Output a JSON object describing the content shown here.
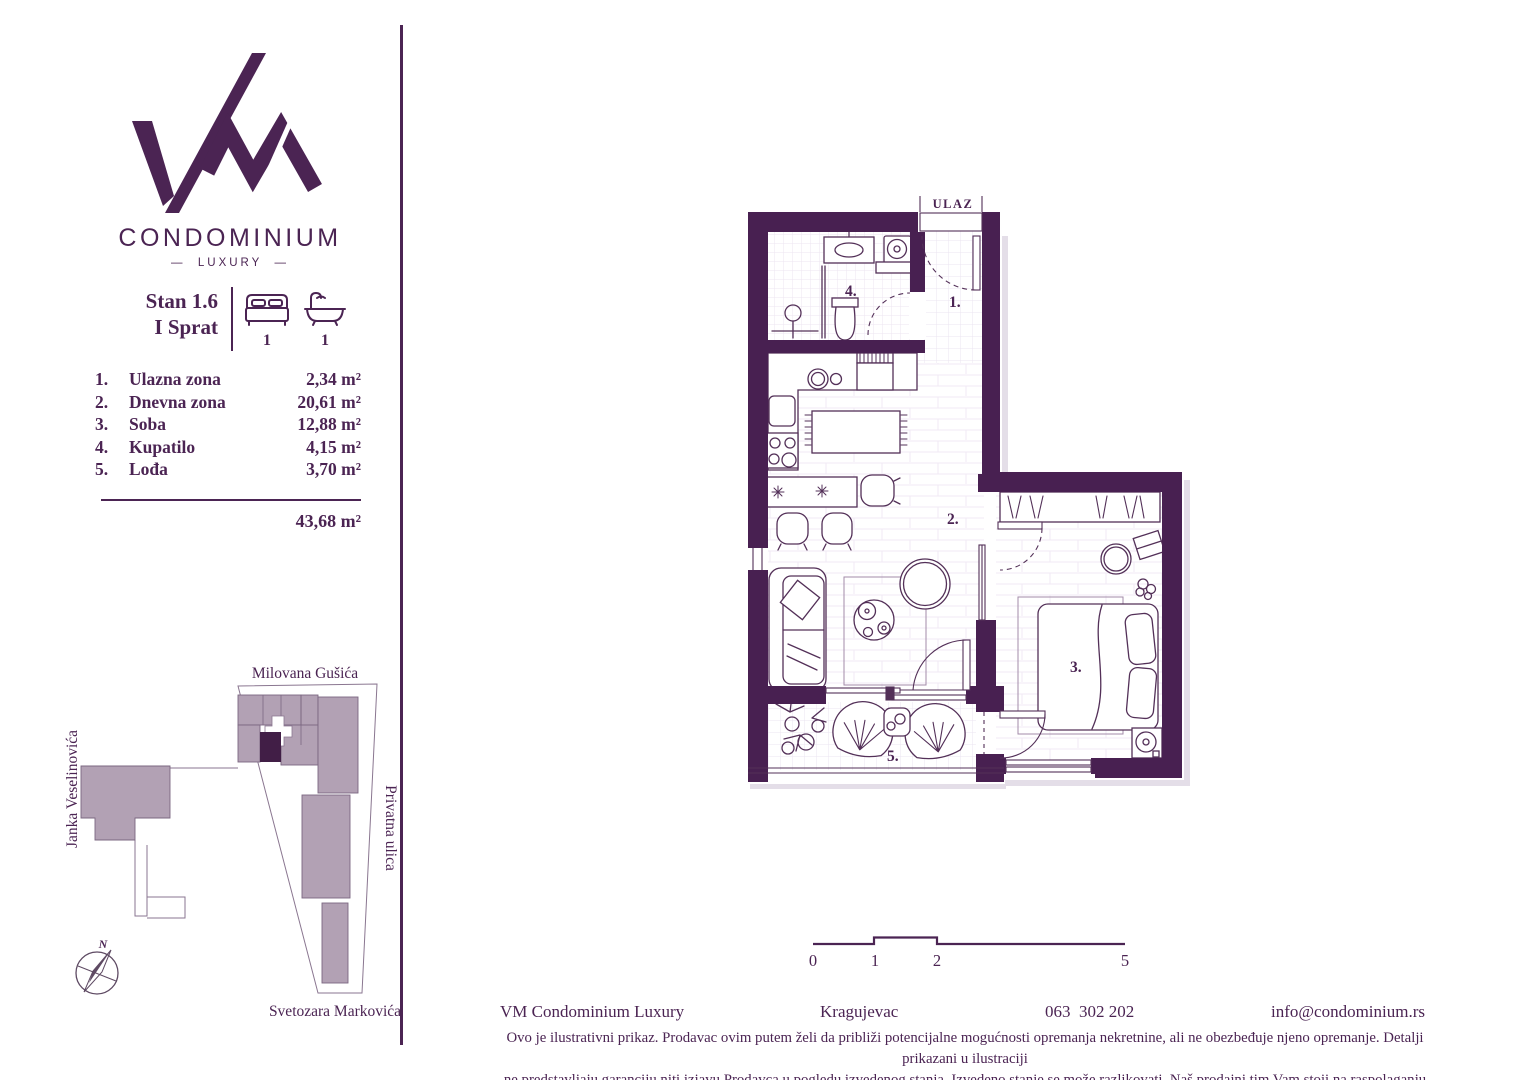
{
  "brand": {
    "monogram": "VM",
    "name": "CONDOMINIUM",
    "tagline_display": "—  LUXURY  —"
  },
  "unit": {
    "title_line1": "Stan 1.6",
    "title_line2": "I Sprat",
    "bedrooms": "1",
    "bathrooms": "1"
  },
  "rooms": {
    "items": [
      {
        "num": "1.",
        "name": "Ulazna zona",
        "area": "2,34 m²"
      },
      {
        "num": "2.",
        "name": "Dnevna zona",
        "area": "20,61 m²"
      },
      {
        "num": "3.",
        "name": "Soba",
        "area": "12,88 m²"
      },
      {
        "num": "4.",
        "name": "Kupatilo",
        "area": "4,15 m²"
      },
      {
        "num": "5.",
        "name": "Lođa",
        "area": "3,70 m²"
      }
    ],
    "total": "43,68 m²"
  },
  "site_plan": {
    "streets": {
      "top": "Milovana Gušića",
      "left": "Janka Veselinovića",
      "right": "Privatna ulica",
      "bottom": "Svetozara Markovića"
    },
    "compass_label": "N",
    "colors": {
      "building": "#b2a1b4",
      "highlight": "#411e46"
    }
  },
  "floor_plan": {
    "entrance_label": "ULAZ",
    "room_numbers": {
      "r1": "1.",
      "r2": "2.",
      "r3": "3.",
      "r4": "4.",
      "r5": "5."
    },
    "wall_color": "#482051"
  },
  "scale_bar": {
    "t0": "0",
    "t1": "1",
    "t2": "2",
    "t5": "5"
  },
  "footer": {
    "company": "VM Condominium Luxury",
    "city": "Kragujevac",
    "phone": "063  302 202",
    "email": "info@condominium.rs",
    "disclaimer_line1": "Ovo je ilustrativni prikaz. Prodavac ovim putem želi da približi potencijalne mogućnosti opremanja nekretnine, ali ne obezbeđuje njeno opremanje. Detalji prikazani u ilustraciji",
    "disclaimer_line2": "ne predstavljaju garanciju niti izjavu Prodavca u pogledu izvedenog stanja. Izvedeno stanje se može razlikovati. Naš prodajni tim Vam stoji na raspolaganju za sve informacije."
  }
}
